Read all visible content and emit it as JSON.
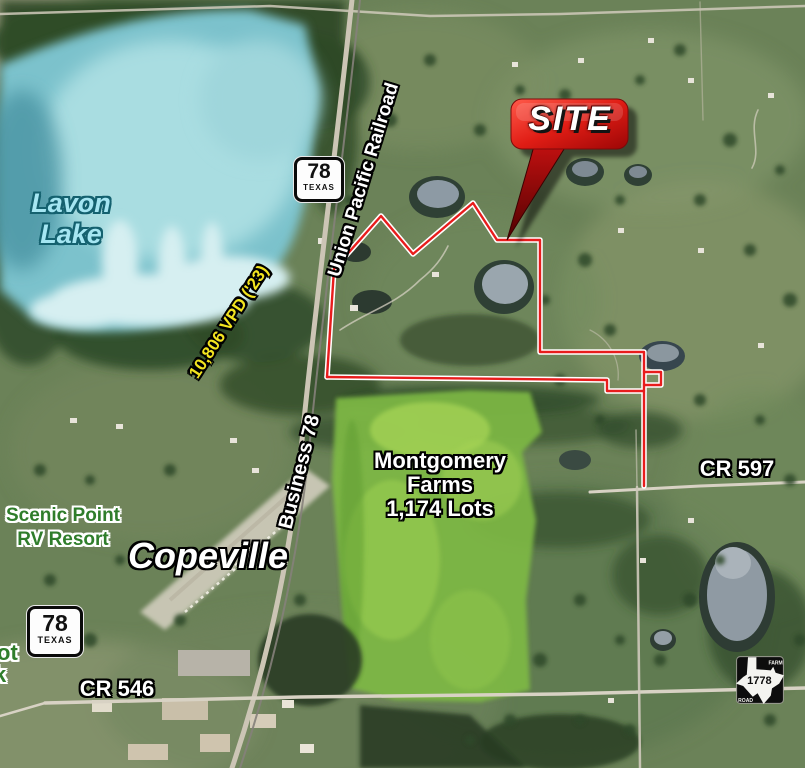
{
  "map": {
    "site_callout": {
      "label": "SITE"
    },
    "lake_label": {
      "line1": "Lavon",
      "line2": "Lake"
    },
    "railroad_label": "Union Pacific Railroad",
    "traffic_count_label": "10,806 VPD ('23)",
    "business_hwy_label": "Business 78",
    "development_label": {
      "line1": "Montgomery",
      "line2": "Farms",
      "line3": "1,174 Lots"
    },
    "rv_resort_label": {
      "line1": "Scenic Point",
      "line2": "RV Resort"
    },
    "town_label": "Copeville",
    "county_road_597_label": "CR 597",
    "county_road_546_label": "CR 546",
    "edge_clipped_label": {
      "line1": "ot",
      "line2": "k"
    },
    "highway_shield_top": {
      "number": "78",
      "state": "TEXAS"
    },
    "highway_shield_bottom": {
      "number": "78",
      "state": "TEXAS"
    },
    "farm_road_sign": {
      "type_top": "FARM",
      "number": "1778",
      "type_bottom": "ROAD"
    },
    "colors": {
      "site_boundary_red": "#e81c1c",
      "boundary_casing_white": "#ffffff",
      "callout_red": "#d01111",
      "traffic_text_yellow": "#f3e41f",
      "lake_text_blue": "#a5e6f2",
      "resort_text_green": "#2f7d2b",
      "lake_water_teal": "#7cc2cc"
    }
  }
}
